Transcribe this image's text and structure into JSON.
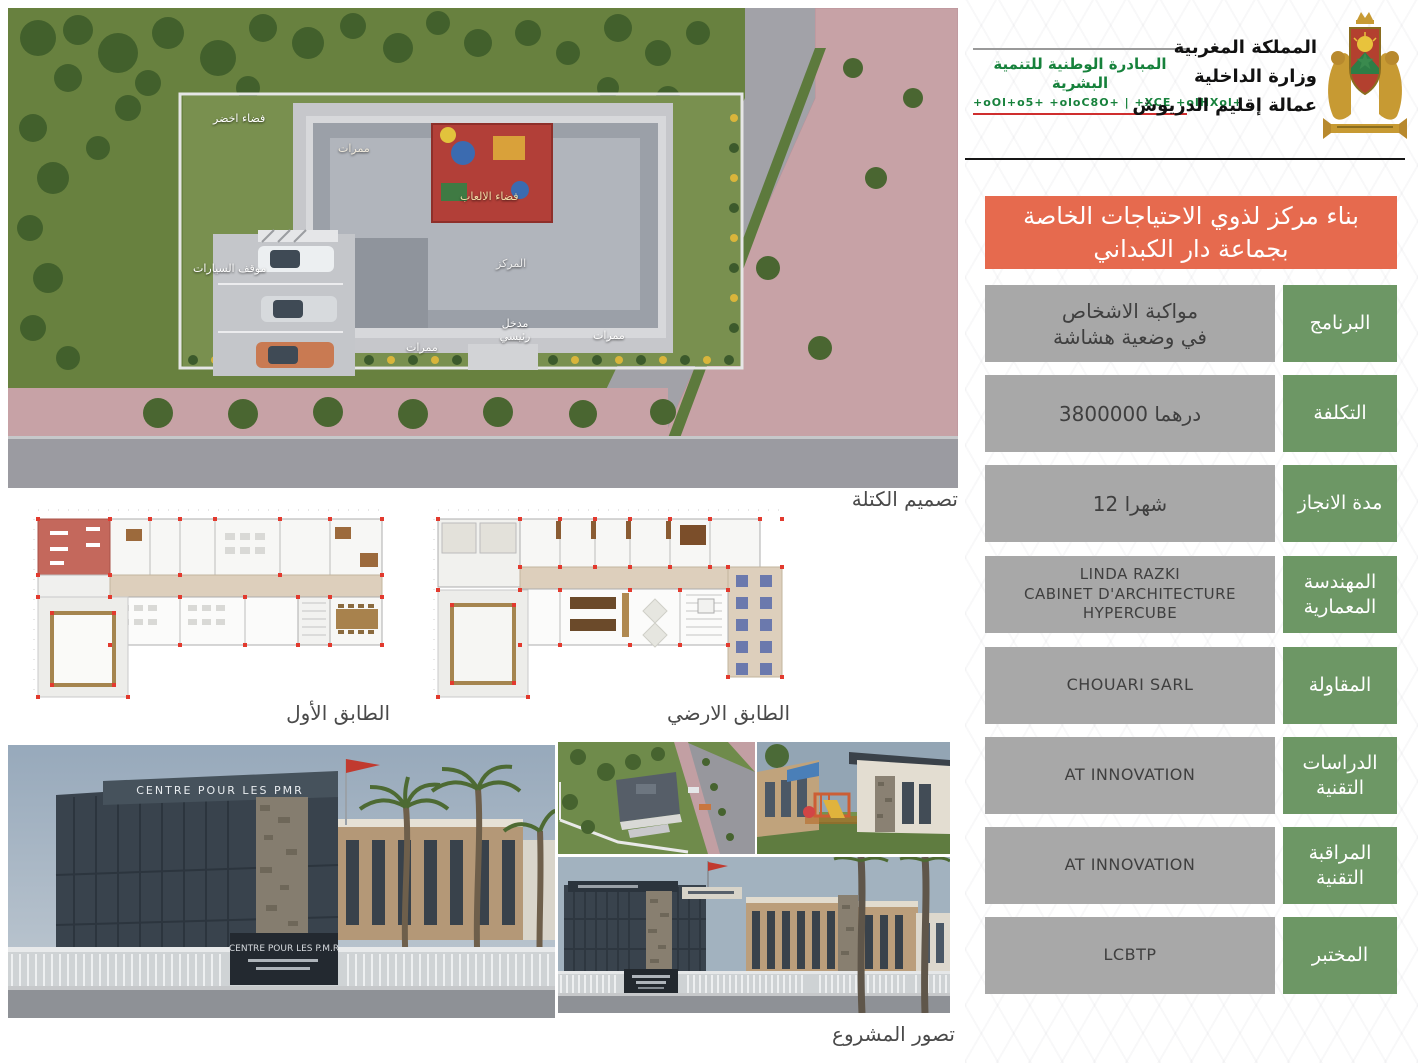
{
  "header": {
    "indh": {
      "arabic": "المبادرة الوطنية للتنمية البشرية",
      "tifinagh": "+oOl+o5+ +oloC8O+ | +XCE +olHXol+"
    },
    "ministry": {
      "line1": "المملكة المغربية",
      "line2": "وزارة الداخلية",
      "line3": "عمالة إقليم الدريوش"
    }
  },
  "banner": {
    "line1": "بناء مركز لذوي الاحتياجات الخاصة",
    "line2": "بجماعة دار الكبداني",
    "bg_color": "#e66a4e"
  },
  "table": {
    "label_bg_color": "#6d9765",
    "value_bg_color": "#a8a8a8",
    "rows": [
      {
        "label": "البرنامج",
        "value": "مواكبة الاشخاص\nفي وضعية هشاشة"
      },
      {
        "label": "التكلفة",
        "value": "3800000 درهما"
      },
      {
        "label": "مدة الانجاز",
        "value": "12 شهرا"
      },
      {
        "label": "المهندسة\nالمعمارية",
        "value": "LINDA RAZKI\nCABINET D'ARCHITECTURE HYPERCUBE"
      },
      {
        "label": "المقاولة",
        "value": "CHOUARI SARL"
      },
      {
        "label": "الدراسات\nالتقنية",
        "value": "AT INNOVATION"
      },
      {
        "label": "المراقبة\nالتقنية",
        "value": "AT INNOVATION"
      },
      {
        "label": "المختبر",
        "value": "LCBTP"
      }
    ]
  },
  "site_plan": {
    "caption": "تصميم الكتلة",
    "labels": [
      {
        "text": "فضاء اخضر"
      },
      {
        "text": "ممرات"
      },
      {
        "text": "فضاء الالعاب"
      },
      {
        "text": "المركز"
      },
      {
        "text": "موقف السيارات"
      },
      {
        "text": "مدخل رئيسي"
      },
      {
        "text": "ممرات"
      },
      {
        "text": "ممرات"
      }
    ]
  },
  "floor_plans": {
    "first_floor_caption": "الطابق الأول",
    "ground_floor_caption": "الطابق الارضي"
  },
  "renders": {
    "caption": "تصور المشروع",
    "building_sign": "CENTRE POUR LES PMR",
    "gate_sign": "CENTRE POUR LES P.M.R"
  }
}
